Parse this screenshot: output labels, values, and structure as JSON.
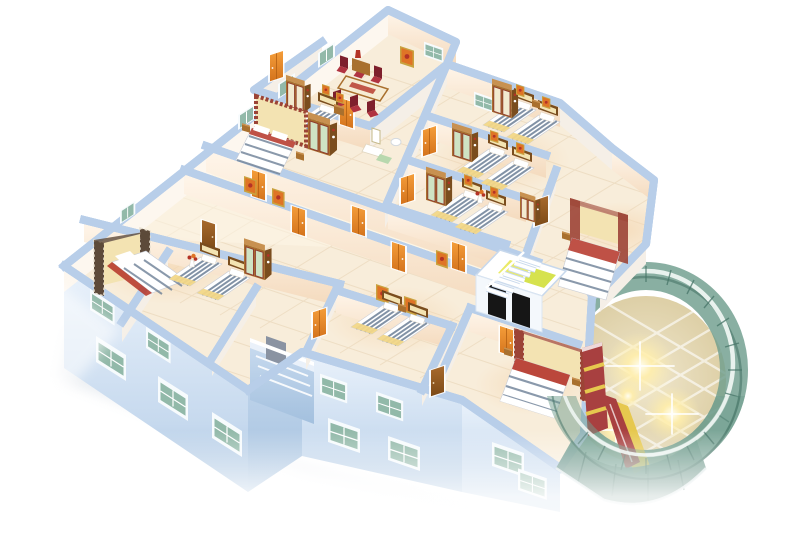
{
  "scene": {
    "type": "isometric-3d-floorplan-cutaway-render",
    "subject": "Bird's-eye cutaway 3D rendering of a furnished hotel floor: bedrooms with striped beds and wooden wardrobes along a central corridor, dining room, elevator core with twin shafts, interior and exterior staircases, and a curved teal-glass atrium rotunda with glowing ceiling lights",
    "background": "white",
    "visible_text": "none"
  },
  "colors": {
    "bg": "#ffffff",
    "floor-cream": "#f8edda",
    "floor-grout": "#e8d4b6",
    "corridor-light": "#fdf6e7",
    "warm-pool": "#f5d7b2",
    "wall-top": "#ffffff",
    "wall-top-mid": "#eaf1fa",
    "wall-edge": "#b7cde9",
    "wall-face": "#fff6eb",
    "wall-face-deep": "#f4dabd",
    "wall-face-cool": "#f5efe7",
    "facade-1": "#eaf2fb",
    "facade-2": "#c6d9ee",
    "facade-3": "#a3c0de",
    "window-frame": "#f7fbfd",
    "window-teal": "#92b9a9",
    "window-teal-dark": "#628f7f",
    "door-orange": "#f49d3a",
    "door-orange-dark": "#d4731c",
    "wood-door": "#a86a2d",
    "wood-door-dark": "#7c4a17",
    "wood-light": "#c89150",
    "wood-mid": "#a9702e",
    "wood-dark": "#7a4d1e",
    "wardrobe-green": "#cfe3c4",
    "wardrobe-cream": "#f2ead0",
    "trim-red": "#8e3b2e",
    "stripe-blue": "#6d8097",
    "blanket-yellow": "#f2d787",
    "headboard-cream": "#f3e3b2",
    "canopy-red": "#9c4436",
    "pillow-white": "#ffffff",
    "chair-red": "#b03340",
    "chair-red-dark": "#7e1f2c",
    "frame-gold": "#c9a23f",
    "art-orange": "#df7426",
    "art-red": "#b43326",
    "glass-teal": "#6f9d8e",
    "glass-teal-deep": "#477568",
    "glass-rim": "#eef5f2",
    "atrium-floor": "#f0e7cd",
    "atrium-floor-deep": "#ddcfa6",
    "grid-white": "#ffffff",
    "flare-core": "#fffdf0",
    "flare-warm": "#ffeeab",
    "shaft-yellow": "#eaea66",
    "shaft-yellow2": "#d6e24e",
    "elevator-black": "#161616",
    "shadow-gray": "#d3dae2",
    "feature-red": "#a84040",
    "feature-yellow": "#e6c84e",
    "green-mat": "#b8d8ae"
  },
  "building": {
    "wall_height_px": 26,
    "wings": [
      "north wing",
      "east rooms",
      "west wing",
      "south rooms",
      "atrium rotunda"
    ],
    "corridor": {
      "orange_doors": 9,
      "wood_doors": 3,
      "wall_paintings": 8
    },
    "rooms": [
      {
        "id": "dining-room",
        "furniture": [
          "long dining table",
          "6 red chairs",
          "sideboard",
          "wall painting",
          "window"
        ]
      },
      {
        "id": "bedroom-n1",
        "furniture": [
          "double bed with checkered canopy frame",
          "green-door wardrobe",
          "nightstands"
        ]
      },
      {
        "id": "bedroom-n2",
        "furniture": [
          "single bed",
          "cream wardrobe",
          "nightstand",
          "two small paintings"
        ]
      },
      {
        "id": "dressing-bath-nook",
        "furniture": [
          "vanity mirror table",
          "stool",
          "toilet",
          "green mat"
        ]
      },
      {
        "id": "twin-room-r1",
        "furniture": [
          "2 striped single beds",
          "cream wardrobe",
          "2 paintings",
          "window"
        ]
      },
      {
        "id": "twin-room-r2",
        "furniture": [
          "2 striped single beds",
          "green wardrobe",
          "2 paintings"
        ]
      },
      {
        "id": "twin-room-r3",
        "furniture": [
          "2 striped single beds",
          "green wardrobe",
          "flower vase figure",
          "2 paintings"
        ]
      },
      {
        "id": "bedroom-east",
        "furniture": [
          "double bed with striped canopy",
          "cream headboard",
          "red pillow band",
          "wood door",
          "small wardrobe"
        ]
      },
      {
        "id": "bedroom-s1",
        "furniture": [
          "double bed with dark checkered canopy",
          "red-trim mattress",
          "pillows"
        ]
      },
      {
        "id": "twin-room-s2",
        "furniture": [
          "2 single beds with yellow blankets",
          "green wardrobe",
          "flower vase"
        ]
      },
      {
        "id": "twin-room-s3",
        "furniture": [
          "2 striped single beds",
          "nightstand",
          "2 paintings"
        ]
      },
      {
        "id": "bedroom-s4",
        "furniture": [
          "double bed with striped canopy posts",
          "red pillows",
          "nightstands"
        ]
      }
    ],
    "elevator_core": {
      "shafts": 2,
      "shaft_floor_color": "yellow",
      "door_color": "black"
    },
    "staircases": [
      {
        "location": "interior, beside elevator core",
        "steps": 7
      },
      {
        "location": "exterior front, center-left"
      }
    ],
    "atrium": {
      "shape": "circular glass rotunda",
      "glass": "teal curtain wall with mullions",
      "floor": "beige marble, diagonal white grid",
      "ceiling_lights": 4,
      "feature_wall": "dark red with yellow stripes",
      "kiosk": "red and yellow counter",
      "lower_story_glass_band": true
    },
    "facades": {
      "stories_below": 2,
      "window_rows": 2,
      "window_glass": "teal",
      "color": "pale blue"
    }
  }
}
